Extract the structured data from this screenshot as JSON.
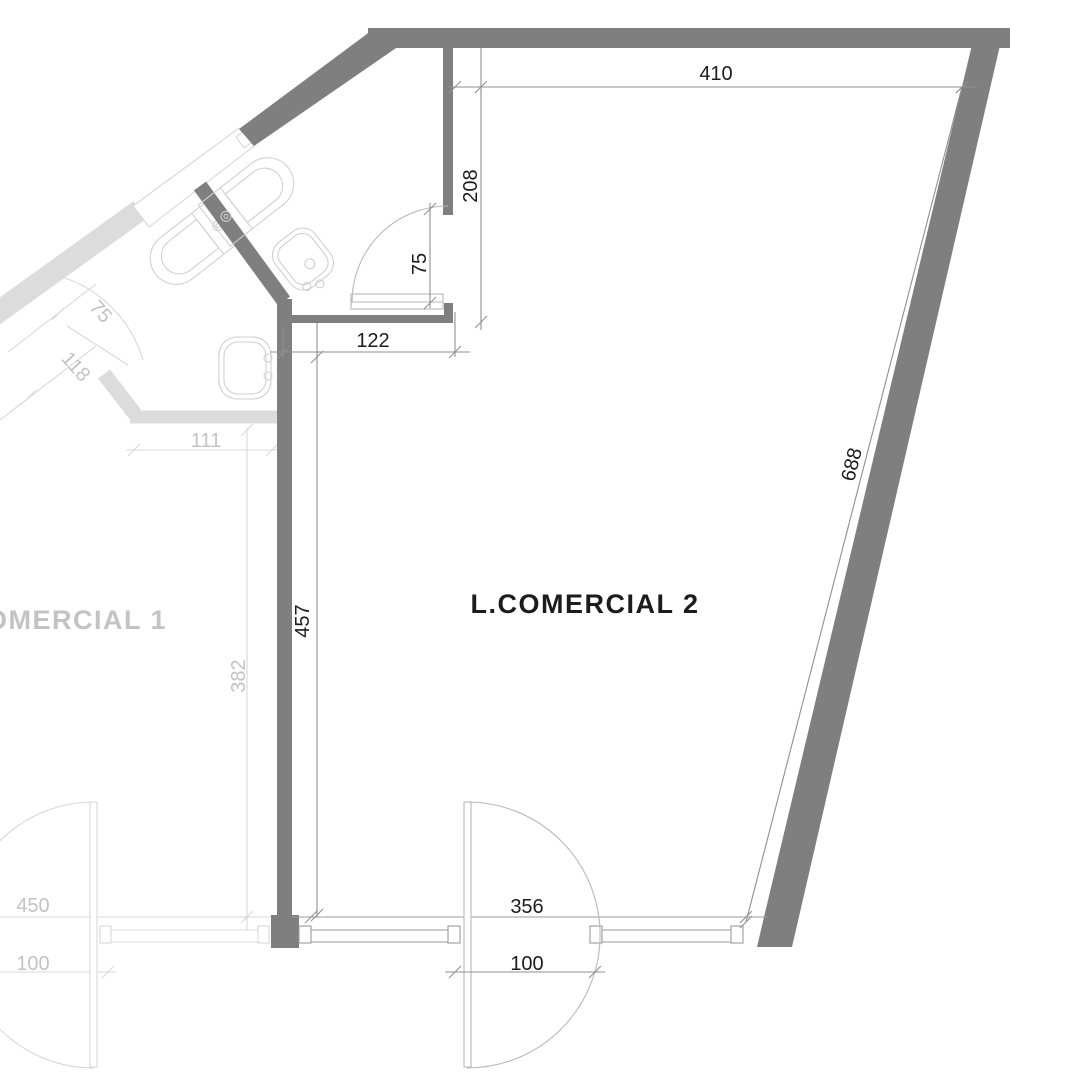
{
  "drawing_title": "Commercial units floor plan",
  "units": {
    "unit2_label": "L.COMERCIAL 2",
    "unit1_label": "L.COMERCIAL 1"
  },
  "dimensions": {
    "top_width": "410",
    "bath_right_wall": "208",
    "bath_door": "75",
    "bath_bottom_wall": "122",
    "left_wall": "457",
    "storefront_width": "356",
    "entry_door": "100",
    "right_wall": "688"
  },
  "neighbor_dimensions": {
    "storefront_width": "450",
    "entry_door": "100",
    "left_wall": "382",
    "bath_bottom_wall": "111",
    "bath_door": "75",
    "bath_wall": "118"
  },
  "colors": {
    "paper": "#ffffff",
    "wall_dark": "#7f7f7f",
    "wall_light": "#dcdcdc",
    "dim_dark": "#8f8f8f",
    "dim_light": "#d8d8d8",
    "frame_dark": "#9a9a9a",
    "door_dark": "#b8b8b8",
    "fixture_light": "#d0d0d0",
    "text_dark": "#1c1c1c",
    "text_light": "#c3c3c3",
    "white": "#ffffff"
  }
}
